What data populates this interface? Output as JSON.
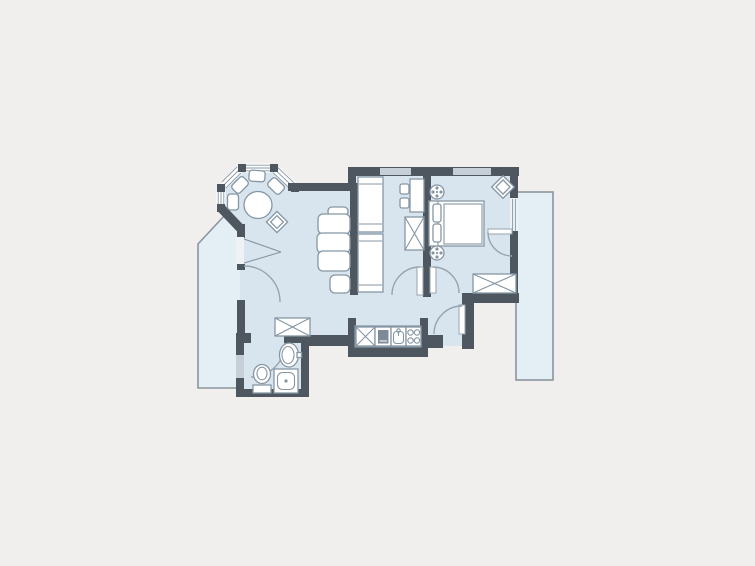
{
  "plan": {
    "label": "Apartment floor plan",
    "rooms": [
      {
        "id": "living-room",
        "label": "living-dining room",
        "furniture": [
          "sofa-three-seat",
          "ottoman",
          "wardrobe-x-box",
          "casement-window"
        ]
      },
      {
        "id": "bay-window-nook",
        "label": "octagonal bay window",
        "furniture": [
          "round-dining-table",
          "fan-chairs-x4",
          "corner-chair-diagonal"
        ]
      },
      {
        "id": "dressing-room",
        "label": "dressing room",
        "furniture": [
          "tall-cabinet-two-sections",
          "desk",
          "stools-x2",
          "closet-x-box"
        ]
      },
      {
        "id": "bedroom",
        "label": "bedroom",
        "furniture": [
          "double-bed",
          "pillows-x2",
          "bedside-lamp-x2",
          "corner-chair-diagonal",
          "closet-x-box"
        ]
      },
      {
        "id": "bathroom",
        "label": "bathroom",
        "furniture": [
          "washbasin",
          "toilet",
          "shower"
        ]
      },
      {
        "id": "kitchenette",
        "label": "kitchen counter",
        "furniture": [
          "cabinet-x-box",
          "oven",
          "sink",
          "stove-four-burner"
        ]
      },
      {
        "id": "hall",
        "label": "entrance hall",
        "furniture": []
      },
      {
        "id": "balcony-left",
        "label": "balcony (slanted)",
        "furniture": []
      },
      {
        "id": "balcony-right",
        "label": "balcony (long)",
        "furniture": []
      }
    ],
    "openings": {
      "entrance_doors": 1,
      "interior_door_swings": 4,
      "balcony_doors": 2,
      "facade_windows": 3,
      "bay_window_panels": 4
    }
  },
  "colors": {
    "bg": "#f1efee",
    "wall": "#4e5760",
    "room": "#d9e5ee",
    "balcony": "#e4eef5",
    "balconyStroke": "#8b959d",
    "furnFill": "#ffffff",
    "furnStroke": "#8596a4",
    "win": "#c6cfd7",
    "arc": "#97a4af",
    "applianceDark": "#7e8b97",
    "glass": "#eef2f5"
  }
}
